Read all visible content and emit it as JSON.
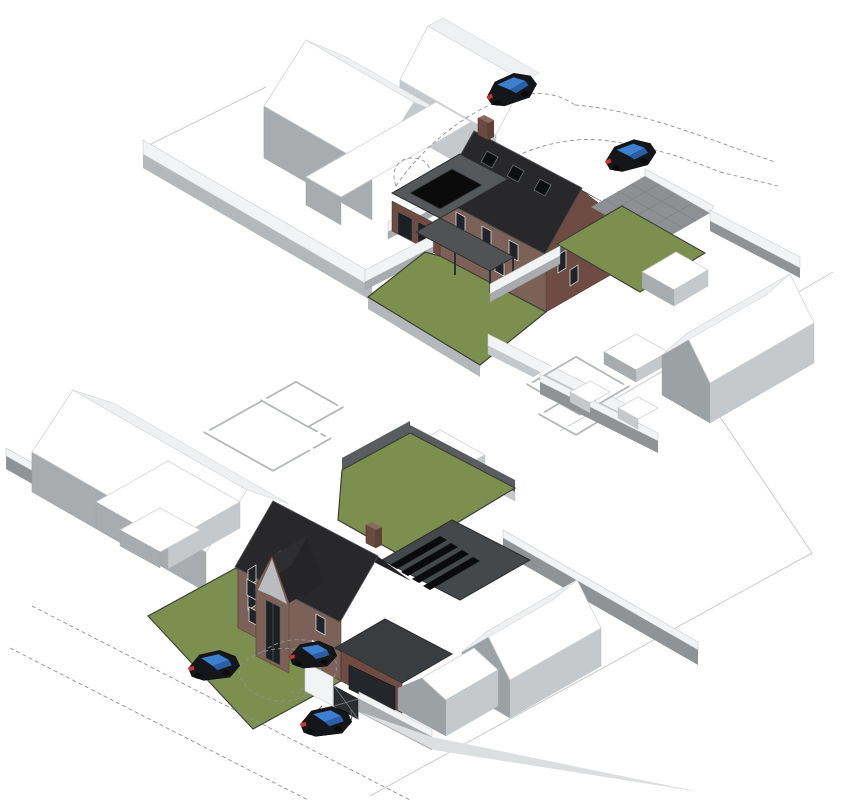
{
  "page": {
    "background": "#ffffff",
    "description": "Two axonometric 3D massing views of a proposed two-storey brick dwelling within its site context"
  },
  "palette": {
    "lawn": "#7d8f4f",
    "lawn_edge": "#3d3f37",
    "brick_front": "#7b6158",
    "brick_side": "#6e4c44",
    "brick_light": "#715349",
    "roof_dark": "#28282b",
    "roof_darker": "#222225",
    "flat_roof": "#55585a",
    "canopy": "#505254",
    "garage_roof": "#3a3d40",
    "solar_roof": "#45484a",
    "solar_panel": "#0b0b0e",
    "skylight": "#0b0b0b",
    "gable_grey": "#b9bdc0",
    "paving": "#8e9193",
    "wall_white": "#f2f3f4",
    "wall_grey": "#a8acae",
    "dark_wall": "#595d5f",
    "car_body": "#141619",
    "car_glass": "#3d7fd0",
    "car_glass_dark": "#2a5ea6",
    "car_tail": "#cc3333",
    "dash_line": "#8f9294"
  },
  "views": [
    {
      "id": "top",
      "name": "rear-garden-axonometric",
      "position": "upper",
      "objects": [
        "neighbour-massing-white",
        "main-house-brick",
        "rear-extension-flat-roof",
        "roof-skylight",
        "rooflights",
        "chimney",
        "canopy-pergola",
        "garden-lawn",
        "side-lawn",
        "paved-driveway",
        "courtyard-walls",
        "neighbour-house-east",
        "road-cars",
        "swept-path-dashes"
      ]
    },
    {
      "id": "bottom",
      "name": "street-front-axonometric",
      "position": "lower",
      "objects": [
        "neighbour-massing-white",
        "courtyard-walls",
        "rear-garden-lawn",
        "boundary-walls",
        "main-house-brick",
        "entrance-gable-glazing",
        "garage-wing",
        "solar-panel-roof",
        "front-lawn",
        "entrance-gate",
        "road-cars",
        "parked-car",
        "swept-path-dashes"
      ]
    }
  ],
  "counts": {
    "cars_top_view": 2,
    "cars_bottom_view_road": 2,
    "cars_bottom_view_driveway": 1,
    "solar_panels": 4,
    "rooflights_top_view": 3
  }
}
